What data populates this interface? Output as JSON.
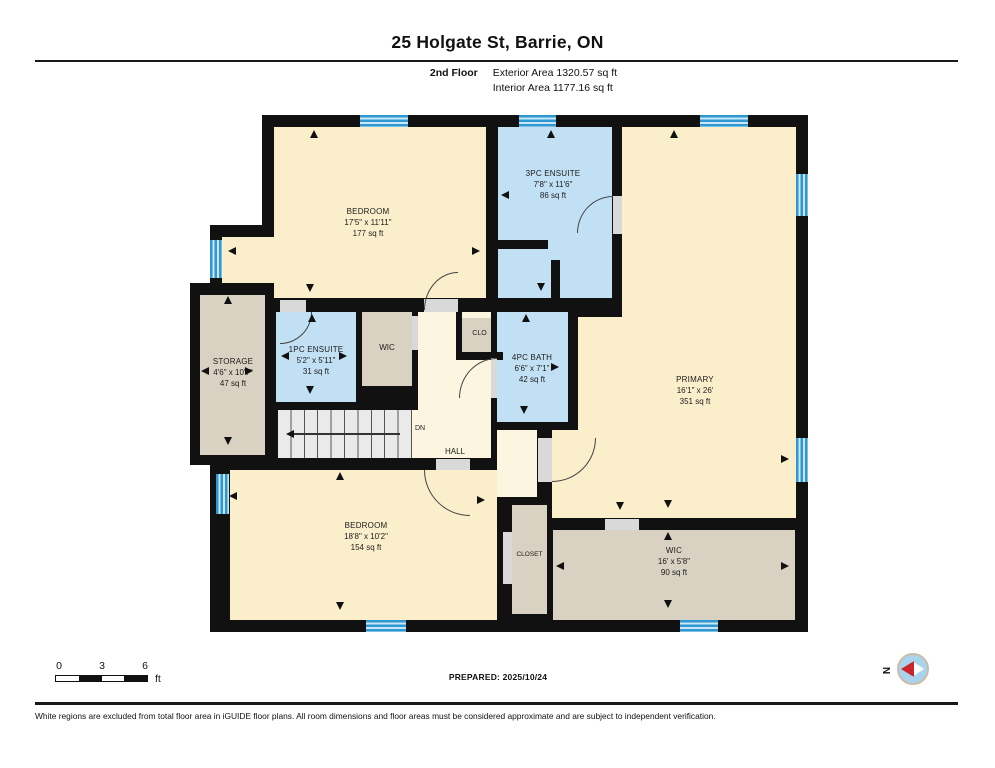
{
  "header": {
    "title": "25 Holgate St, Barrie, ON",
    "floor_label": "2nd Floor",
    "exterior_area": "Exterior Area 1320.57 sq ft",
    "interior_area": "Interior Area 1177.16 sq ft"
  },
  "rooms": {
    "bedroom_tl": {
      "name": "BEDROOM",
      "dims": "17'5\" x 11'11\"",
      "area": "177 sq ft"
    },
    "ensuite_3pc": {
      "name": "3PC ENSUITE",
      "dims": "7'8\" x 11'6\"",
      "area": "86 sq ft"
    },
    "primary": {
      "name": "PRIMARY",
      "dims": "16'1\" x 26'",
      "area": "351 sq ft"
    },
    "storage": {
      "name": "STORAGE",
      "dims": "4'6\" x 10'7\"",
      "area": "47 sq ft"
    },
    "ensuite_1pc": {
      "name": "1PC ENSUITE",
      "dims": "5'2\" x 5'11\"",
      "area": "31 sq ft"
    },
    "wic_top": {
      "name": "WIC"
    },
    "bath_4pc": {
      "name": "4PC BATH",
      "dims": "6'6\" x 7'1\"",
      "area": "42 sq ft"
    },
    "clo": {
      "name": "CLO"
    },
    "hall": {
      "name": "HALL"
    },
    "stairs": {
      "dn": "DN"
    },
    "bedroom_bot": {
      "name": "BEDROOM",
      "dims": "18'8\" x 10'2\"",
      "area": "154 sq ft"
    },
    "closet": {
      "name": "CLOSET"
    },
    "wic_bot": {
      "name": "WIC",
      "dims": "16' x 5'8\"",
      "area": "90 sq ft"
    }
  },
  "footer": {
    "scale": {
      "n0": "0",
      "n3": "3",
      "n6": "6",
      "unit": "ft"
    },
    "prepared": "PREPARED: 2025/10/24",
    "north": "N",
    "disclaimer": "White regions are excluded from total floor area in iGUIDE floor plans. All room dimensions and floor areas must be considered approximate and are subject to independent verification."
  },
  "colors": {
    "room_cream": "#fbeecb",
    "hall_cream": "#fcf5e0",
    "room_blue": "#c2e0f4",
    "room_tan": "#d9d1c1",
    "wall": "#111111",
    "window_blue": "#2f98d2",
    "north_blue": "#a9d4ee",
    "north_red": "#c9252b"
  }
}
